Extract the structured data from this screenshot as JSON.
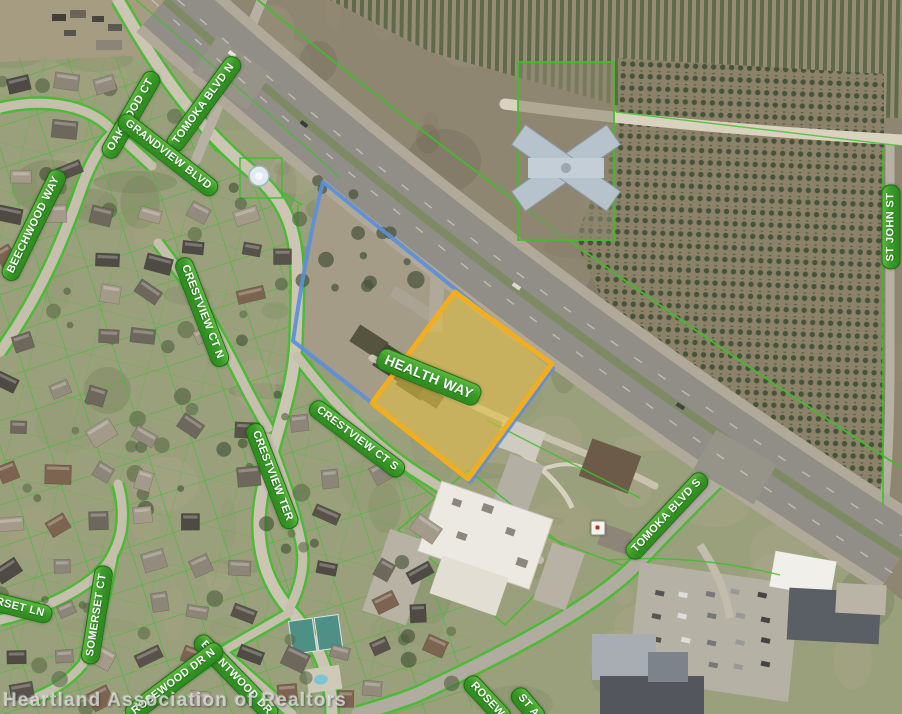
{
  "map": {
    "watermark": "Heartland Association of Realtors",
    "street_labels": [
      {
        "text": "OAKWOOD CT",
        "x": 131,
        "y": 115,
        "rot": -60
      },
      {
        "text": "TOMOKA BLVD N",
        "x": 204,
        "y": 104,
        "rot": -54
      },
      {
        "text": "GRANDVIEW BLVD",
        "x": 168,
        "y": 155,
        "rot": 38
      },
      {
        "text": "BEECHWOOD WAY",
        "x": 34,
        "y": 225,
        "rot": -64
      },
      {
        "text": "CRESTVIEW CT N",
        "x": 202,
        "y": 312,
        "rot": 69
      },
      {
        "text": "CRESTVIEW TER",
        "x": 272,
        "y": 476,
        "rot": 69
      },
      {
        "text": "CRESTVIEW CT S",
        "x": 357,
        "y": 439,
        "rot": 37
      },
      {
        "text": "HEALTH WAY",
        "x": 429,
        "y": 377,
        "rot": 22,
        "size": 14
      },
      {
        "text": "ST JOHN ST",
        "x": 891,
        "y": 227,
        "rot": -90
      },
      {
        "text": "TOMOKA BLVD S",
        "x": 667,
        "y": 516,
        "rot": -47
      },
      {
        "text": "SOMERSET CT",
        "x": 97,
        "y": 615,
        "rot": -81
      },
      {
        "text": "RSET LN",
        "x": 20,
        "y": 608,
        "rot": 14
      },
      {
        "text": "BRENTWOOD DR",
        "x": 236,
        "y": 678,
        "rot": 46
      },
      {
        "text": "ROSEWOOD DR N",
        "x": 174,
        "y": 682,
        "rot": -37
      },
      {
        "text": "ROSEW",
        "x": 487,
        "y": 700,
        "rot": 47
      },
      {
        "text": "ST A",
        "x": 528,
        "y": 706,
        "rot": 50
      }
    ],
    "overlays": {
      "subject_parcel": {
        "stroke": "#F2AE1E",
        "fill": "rgba(233,198,52,0.5)",
        "points": "372,403 455,292 552,364 468,479"
      },
      "boundary_line": {
        "stroke": "#5B8FD9",
        "path": "M 323,182 L 553,368 L 470,482 L 372,403 L 293,341 C 300,292 311,228 323,182"
      }
    },
    "marker": {
      "x": 598,
      "y": 528
    },
    "colors": {
      "label_bg": "#3A9C28",
      "label_border": "#1D6F12",
      "parcel_line": "#3FBE2B",
      "highlight_yellow": "#F2AE1E",
      "boundary_blue": "#5B8FD9"
    }
  }
}
